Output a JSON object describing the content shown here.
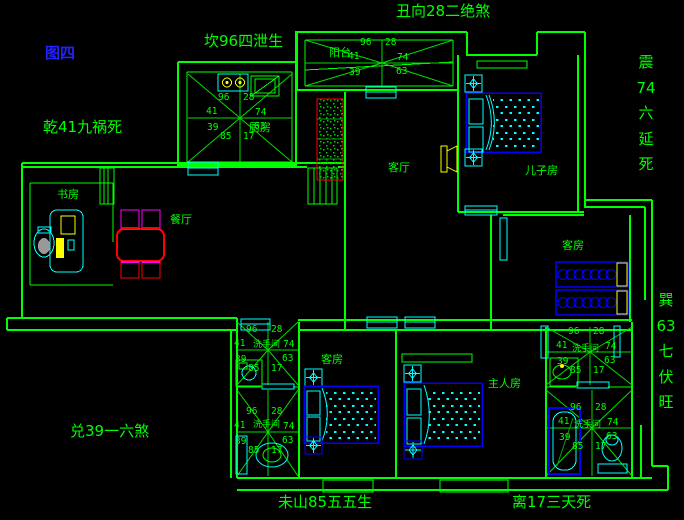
{
  "figure": {
    "label": "图四"
  },
  "annotations": {
    "north": "坎96四泄生",
    "northeast": "丑向28二绝煞",
    "northwest": "乾41九祸死",
    "east_upper": "震74六延死",
    "east_lower": "巽63七伏旺",
    "west": "兑39一六煞",
    "south_left": "未山85五五生",
    "south_right": "离17三天死"
  },
  "rooms": {
    "kitchen": "厨房",
    "balcony": "阳台",
    "living": "客厅",
    "son": "儿子房",
    "guest": "客房",
    "study": "书房",
    "dining": "餐厅",
    "master": "主人房",
    "bathroom": "洗手间"
  },
  "star_numbers": {
    "n1": "96",
    "n2": "28",
    "w": "41",
    "e": "74",
    "sw": "39",
    "se": "63",
    "s1": "85",
    "s2": "17"
  },
  "colors": {
    "background": "#000000",
    "wall_green": "#00ff00",
    "fixture_cyan": "#00ffff",
    "furniture_blue": "#0000ff",
    "accent_red": "#ff0000",
    "accent_magenta": "#ff00ff",
    "accent_yellow": "#ffff00",
    "figure_blue": "#2222ff"
  }
}
